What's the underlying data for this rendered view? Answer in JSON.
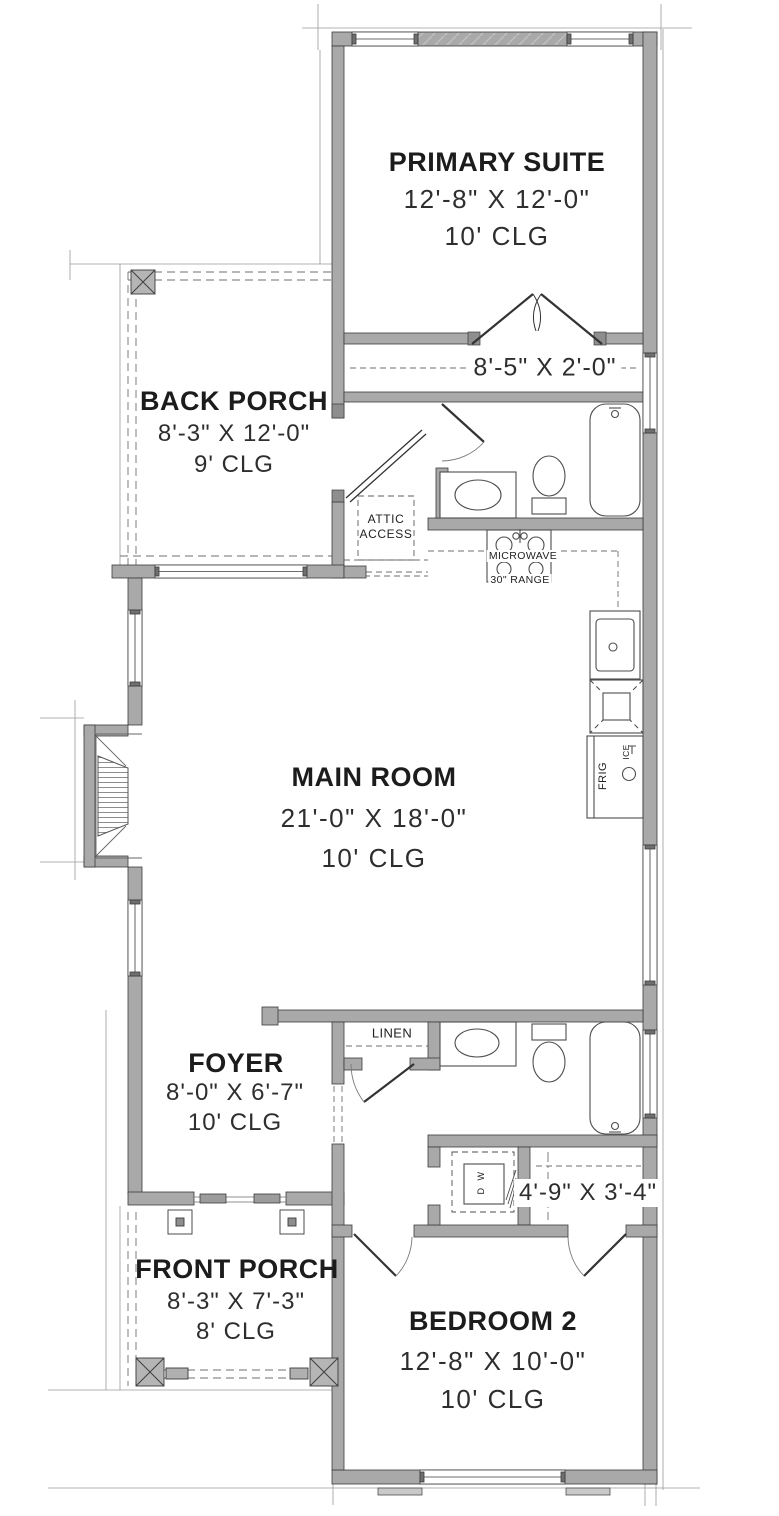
{
  "plan": {
    "rooms": [
      {
        "id": "primary-suite",
        "name": "PRIMARY SUITE",
        "dims": "12'-8\" X 12'-0\"",
        "ceiling": "10' CLG"
      },
      {
        "id": "back-porch",
        "name": "BACK PORCH",
        "dims": "8'-3\" X 12'-0\"",
        "ceiling": "9' CLG"
      },
      {
        "id": "main-room",
        "name": "MAIN ROOM",
        "dims": "21'-0\" X 18'-0\"",
        "ceiling": "10' CLG"
      },
      {
        "id": "foyer",
        "name": "FOYER",
        "dims": "8'-0\" X 6'-7\"",
        "ceiling": "10' CLG"
      },
      {
        "id": "front-porch",
        "name": "FRONT PORCH",
        "dims": "8'-3\" X 7'-3\"",
        "ceiling": "8' CLG"
      },
      {
        "id": "bedroom-2",
        "name": "BEDROOM 2",
        "dims": "12'-8\" X 10'-0\"",
        "ceiling": "10' CLG"
      }
    ],
    "closets": {
      "primary_closet_dims": "8'-5\" X 2'-0\"",
      "bedroom2_closet_dims": "4'-9\" X 3'-4\""
    },
    "fixtures": {
      "attic_line1": "ATTIC",
      "attic_line2": "ACCESS",
      "microwave": "MICROWAVE",
      "range": "30\" RANGE",
      "linen": "LINEN",
      "fridge": "FRIG",
      "ice": "ICE",
      "washer": "W",
      "dryer": "D"
    },
    "colors": {
      "wall_fill": "#a9a9a9",
      "wall_line": "#3b3b3b",
      "thin_line": "#8a8a8a",
      "text": "#1c1c1c"
    }
  }
}
